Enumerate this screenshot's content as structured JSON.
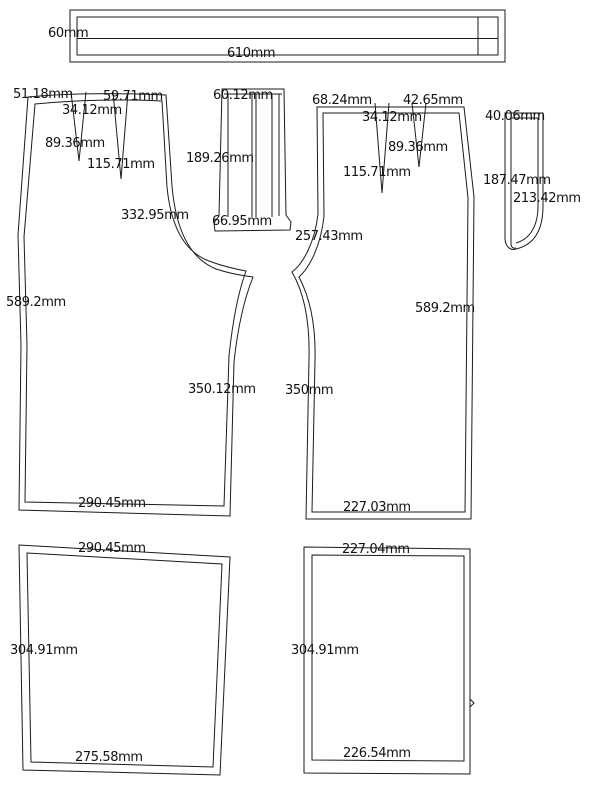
{
  "colors": {
    "line": "#1b1b1b",
    "text": "#111111",
    "background": "#ffffff"
  },
  "unit": "mm",
  "pieces": {
    "waistband": {
      "height": "60mm",
      "length": "610mm"
    },
    "left_panel": {
      "waist_edge": "51.18mm",
      "dart_spacing": "59.71mm",
      "dart_offset": "34.12mm",
      "dart_depth_shallow": "89.36mm",
      "dart_depth_deep": "115.71mm",
      "crotch_seam": "332.95mm",
      "side_seam": "589.2mm",
      "inseam": "350.12mm",
      "hem": "290.45mm"
    },
    "fly_facing": {
      "top": "60.12mm",
      "length": "189.26mm",
      "bottom": "66.95mm"
    },
    "right_panel": {
      "waist_edge": "68.24mm",
      "dart_spacing": "42.65mm",
      "dart_offset": "34.12mm",
      "dart_depth_shallow": "89.36mm",
      "dart_depth_deep": "115.71mm",
      "crotch_seam": "257.43mm",
      "side_seam": "589.2mm",
      "inseam": "350mm",
      "hem": "227.03mm"
    },
    "fly_shield": {
      "top": "40.06mm",
      "length_inner": "187.47mm",
      "length_outer": "213.42mm"
    },
    "left_lining": {
      "top": "290.45mm",
      "side": "304.91mm",
      "bottom": "275.58mm"
    },
    "right_lining": {
      "top": "227.04mm",
      "side": "304.91mm",
      "bottom": "226.54mm"
    }
  }
}
